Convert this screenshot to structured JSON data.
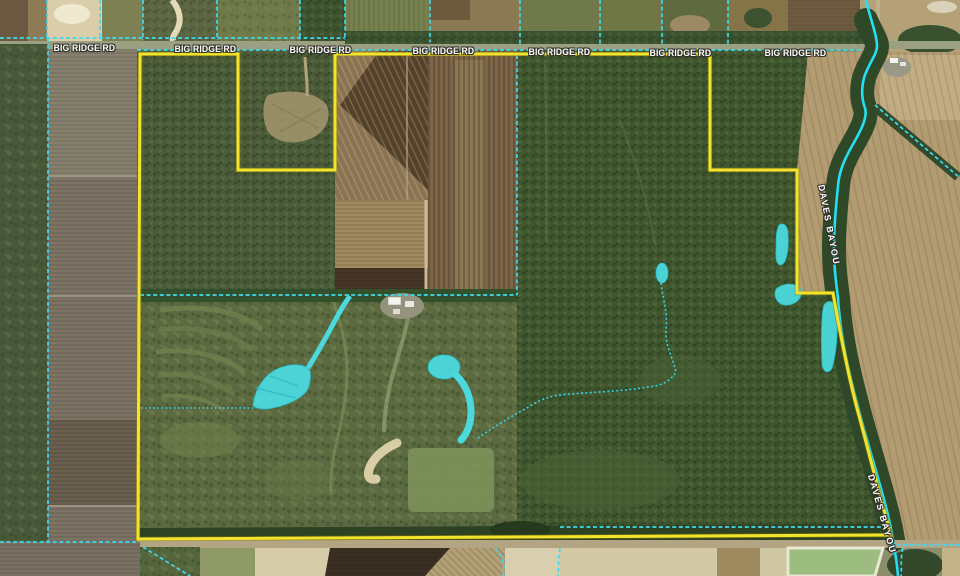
{
  "map": {
    "road": {
      "label": "BIG RIDGE RD",
      "label_count": 7
    },
    "waterway": {
      "label": "DAVES BAYOU",
      "label_count": 2
    },
    "colors": {
      "parcel_boundary_yellow": "#F2E42C",
      "parcel_line_cyan": "#3ED9F0",
      "waterway_cyan": "#25DFF2",
      "wetland_fill": "#4CD9DD"
    }
  }
}
